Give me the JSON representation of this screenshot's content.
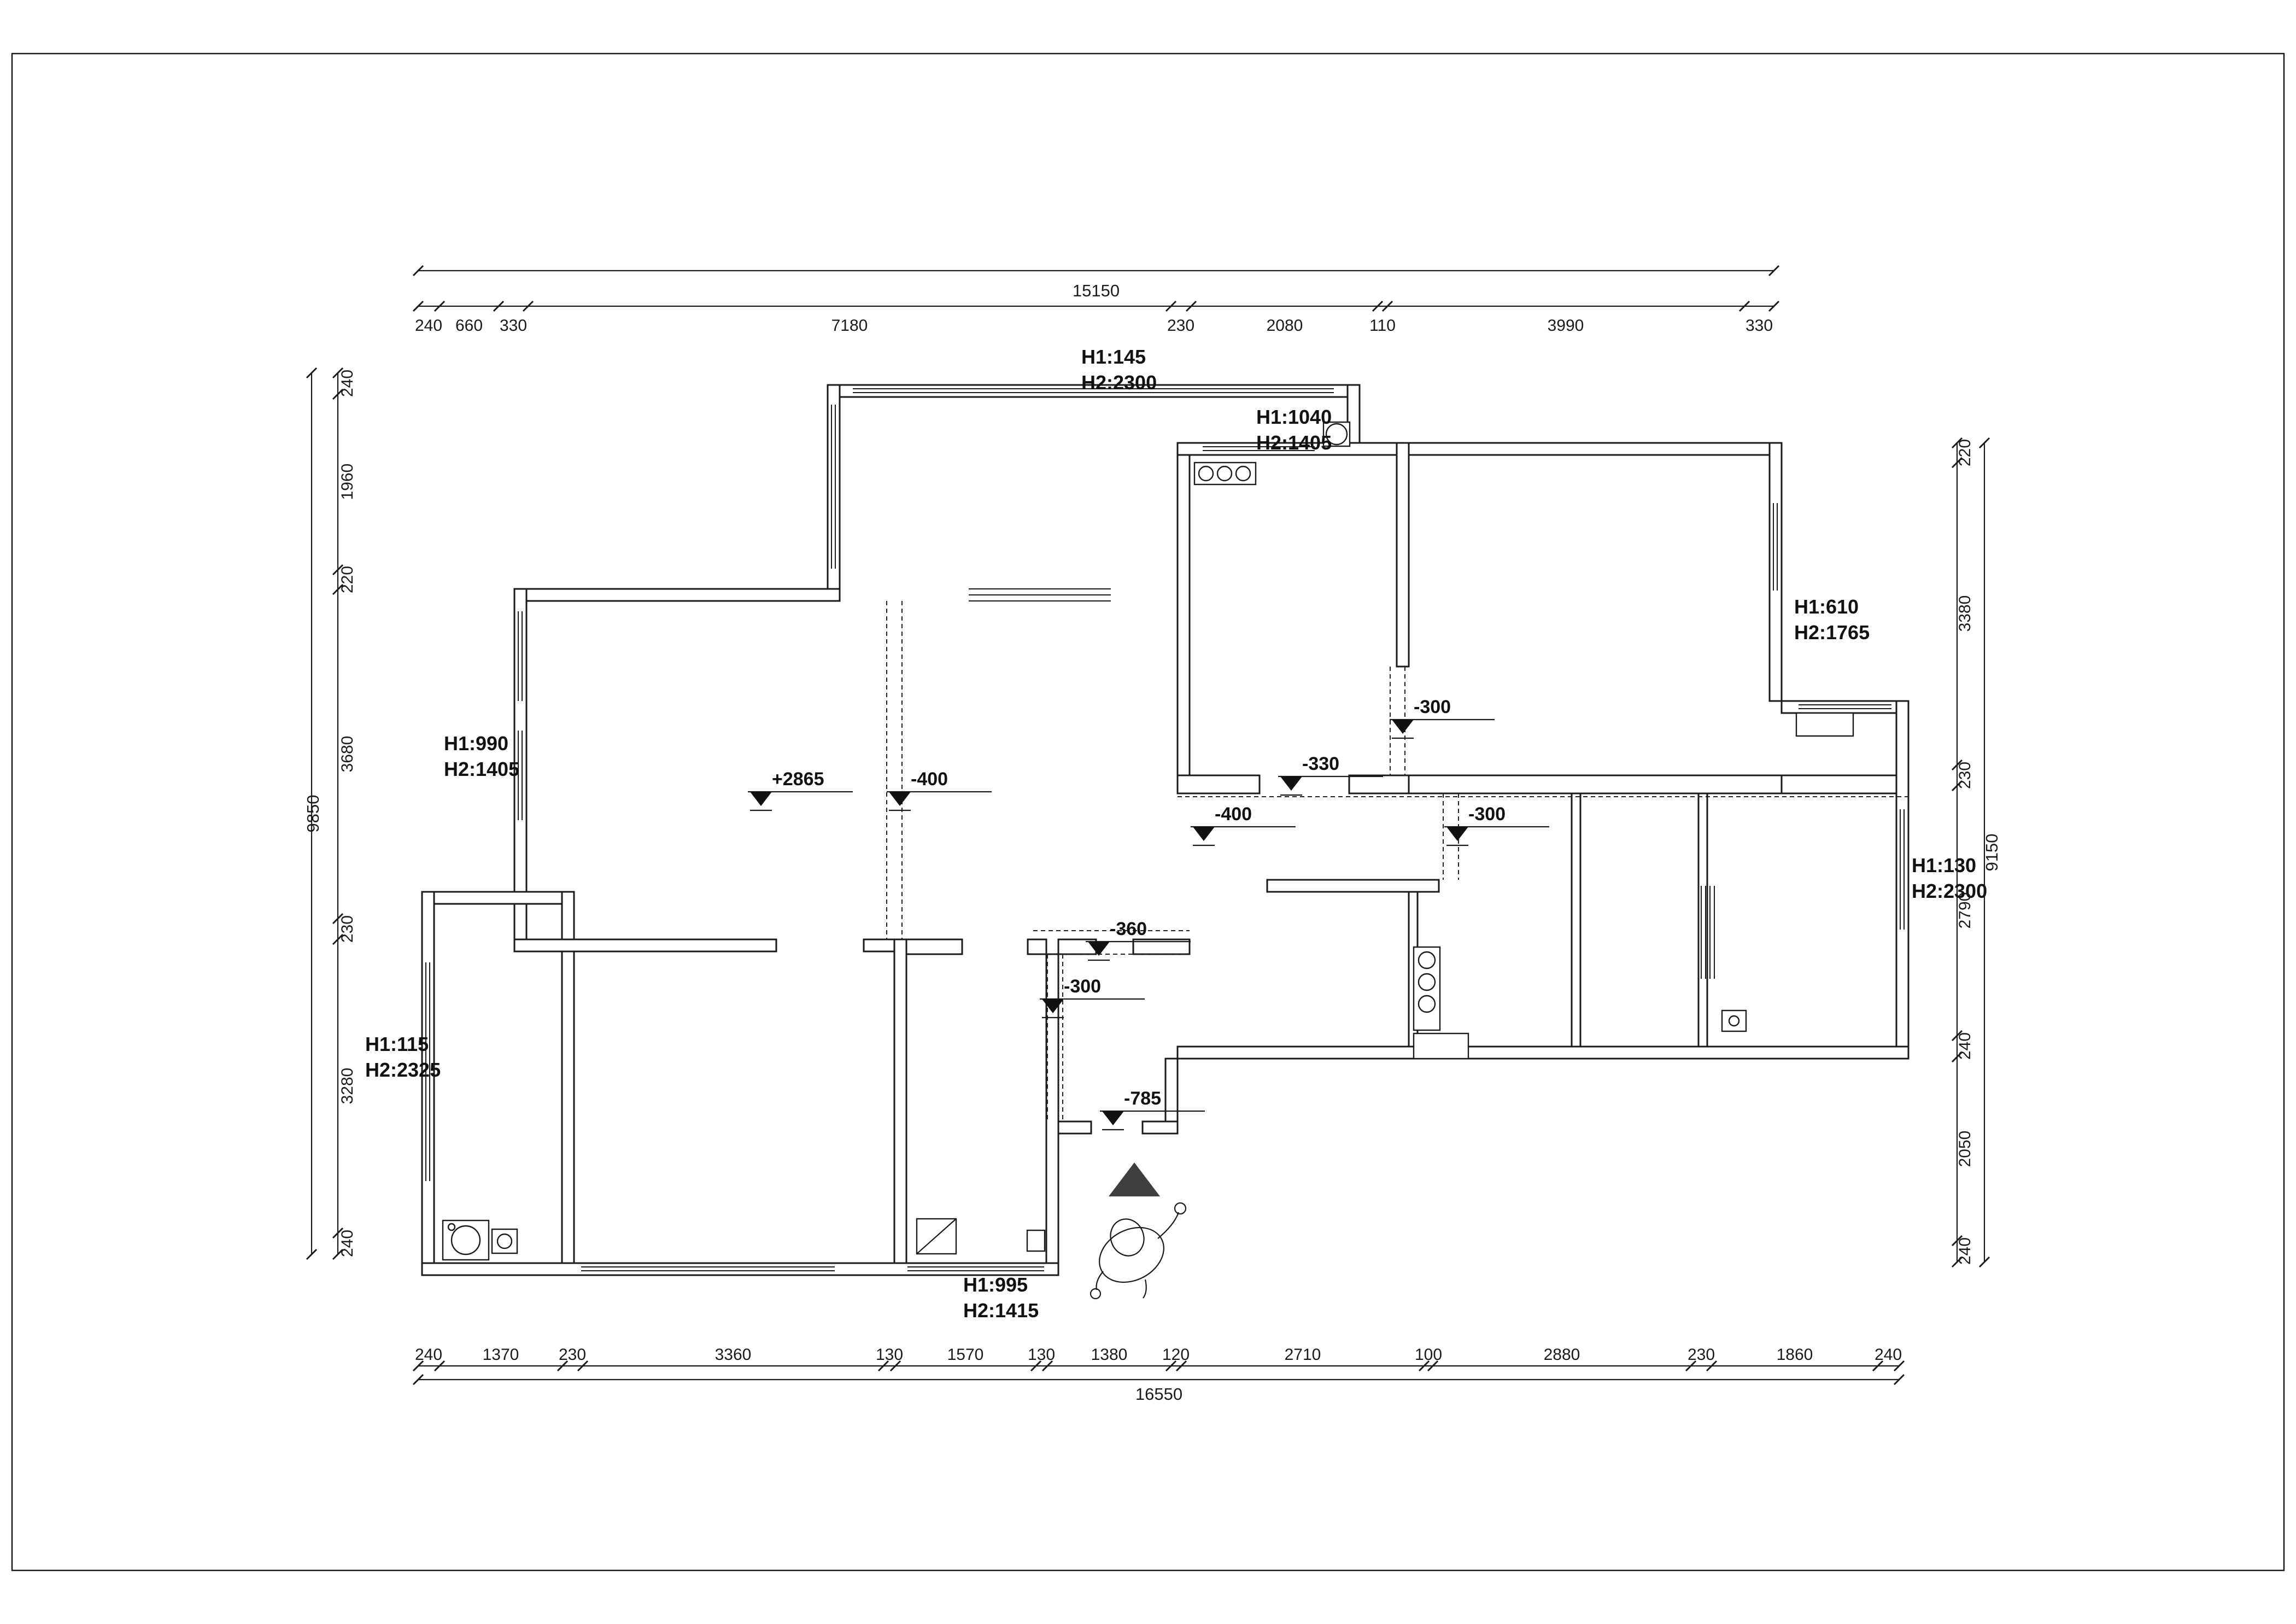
{
  "drawing": {
    "type": "residential floor plan with ceiling/level annotations",
    "background": "#ffffff",
    "line_color": "#1a1a1a",
    "entrance_arrow_color": "#3f3f3f"
  },
  "dimensions": {
    "top": {
      "total": "15150",
      "segments": [
        "240",
        "660",
        "330",
        "7180",
        "230",
        "2080",
        "110",
        "3990",
        "330"
      ]
    },
    "bottom": {
      "total": "16550",
      "segments": [
        "240",
        "1370",
        "230",
        "3360",
        "130",
        "1570",
        "130",
        "1380",
        "120",
        "2710",
        "100",
        "2880",
        "230",
        "1860",
        "240"
      ]
    },
    "left": {
      "total": "9850",
      "segments": [
        "240",
        "1960",
        "220",
        "3680",
        "230",
        "3280",
        "240"
      ]
    },
    "right": {
      "total": "9150",
      "segments": [
        "220",
        "3380",
        "230",
        "2790",
        "240",
        "2050",
        "240"
      ]
    }
  },
  "annotations": [
    {
      "line1": "H1:145",
      "line2": "H2:2300"
    },
    {
      "line1": "H1:1040",
      "line2": "H2:1405"
    },
    {
      "line1": "H1:610",
      "line2": "H2:1765"
    },
    {
      "line1": "H1:990",
      "line2": "H2:1405"
    },
    {
      "line1": "H1:115",
      "line2": "H2:2325"
    },
    {
      "line1": "H1:130",
      "line2": "H2:2300"
    },
    {
      "line1": "H1:995",
      "line2": "H2:1415"
    }
  ],
  "levels": [
    "+2865",
    "-400",
    "-300",
    "-330",
    "-400",
    "-300",
    "-360",
    "-300",
    "-785"
  ]
}
